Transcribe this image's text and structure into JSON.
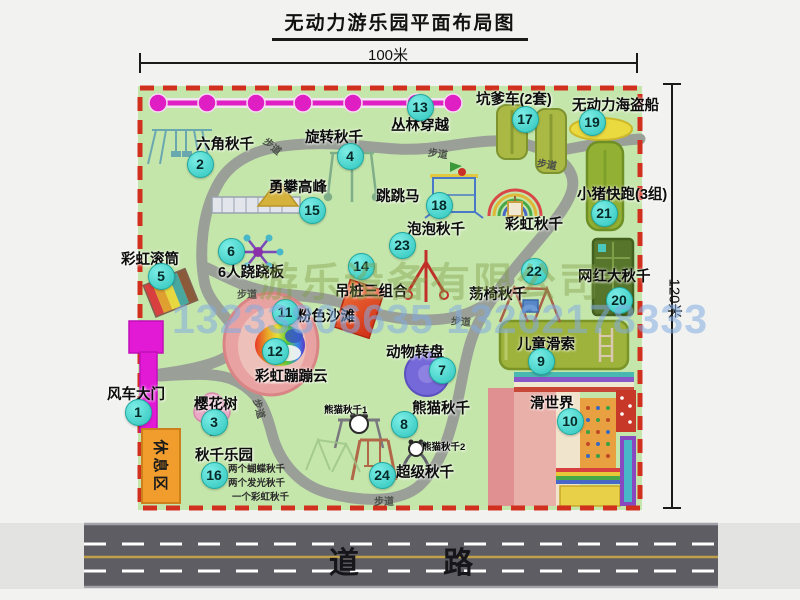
{
  "title": "无动力游乐园平面布局图",
  "dimensions": {
    "width_label": "100米",
    "height_label": "120米"
  },
  "road": {
    "label": "道 路"
  },
  "watermark": {
    "company": "游乐设备有限公司",
    "phone": "13233806635 13262178333"
  },
  "rest_area_label": "休息区",
  "trail_label": "步道",
  "swing_park_notes": [
    "两个蝴蝶秋千",
    "两个发光秋千",
    "一个彩虹秋千"
  ],
  "colors": {
    "map_green": "#c5e6ab",
    "border_red": "#d1301f",
    "badge_teal": "#3fd4cc",
    "gate_magenta": "#e21ad6",
    "rest_area_orange": "#f09d2e",
    "road_gray": "#5d5d63",
    "jungle_line_magenta": "#df1fc3"
  },
  "features": [
    {
      "key": "windmill-gate",
      "num": "1",
      "label": "风车大门"
    },
    {
      "key": "hex-swing",
      "num": "2",
      "label": "六角秋千"
    },
    {
      "key": "cherry-tree",
      "num": "3",
      "label": "樱花树"
    },
    {
      "key": "rotating-swing",
      "num": "4",
      "label": "旋转秋千"
    },
    {
      "key": "rainbow-roller",
      "num": "5",
      "label": "彩虹滚筒"
    },
    {
      "key": "six-seesaw",
      "num": "6",
      "label": "6人跷跷板"
    },
    {
      "key": "animal-turntable",
      "num": "7",
      "label": "动物转盘"
    },
    {
      "key": "panda-swing",
      "num": "8",
      "label": "熊猫秋千"
    },
    {
      "key": "kids-zipline",
      "num": "9",
      "label": "儿童滑索"
    },
    {
      "key": "slide-world",
      "num": "10",
      "label": "滑世界"
    },
    {
      "key": "pink-beach",
      "num": "11",
      "label": "粉色沙滩"
    },
    {
      "key": "rainbow-cloud",
      "num": "12",
      "label": "彩虹蹦蹦云"
    },
    {
      "key": "jungle-crossing",
      "num": "13",
      "label": "丛林穿越"
    },
    {
      "key": "hanging-pile",
      "num": "14",
      "label": "吊桩三组合"
    },
    {
      "key": "climbing-peak",
      "num": "15",
      "label": "勇攀高峰"
    },
    {
      "key": "swing-park",
      "num": "16",
      "label": "秋千乐园"
    },
    {
      "key": "pit-car",
      "num": "17",
      "label": "坑爹车(2套)"
    },
    {
      "key": "jumping-horse",
      "num": "18",
      "label": "跳跳马"
    },
    {
      "key": "pirate-ship",
      "num": "19",
      "label": "无动力海盗船"
    },
    {
      "key": "big-swing",
      "num": "20",
      "label": "网红大秋千"
    },
    {
      "key": "piggy-run",
      "num": "21",
      "label": "小猪快跑(3组)"
    },
    {
      "key": "chair-swing",
      "num": "22",
      "label": "荡椅秋千"
    },
    {
      "key": "bubble-swing",
      "num": "23",
      "label": "泡泡秋千"
    },
    {
      "key": "super-swing",
      "num": "24",
      "label": "超级秋千"
    },
    {
      "key": "rainbow-swing",
      "num": "",
      "label": "彩虹秋千"
    },
    {
      "key": "panda-swing-1",
      "num": "",
      "label": "熊猫秋千1"
    },
    {
      "key": "panda-swing-2",
      "num": "",
      "label": "熊猫秋千2"
    }
  ]
}
